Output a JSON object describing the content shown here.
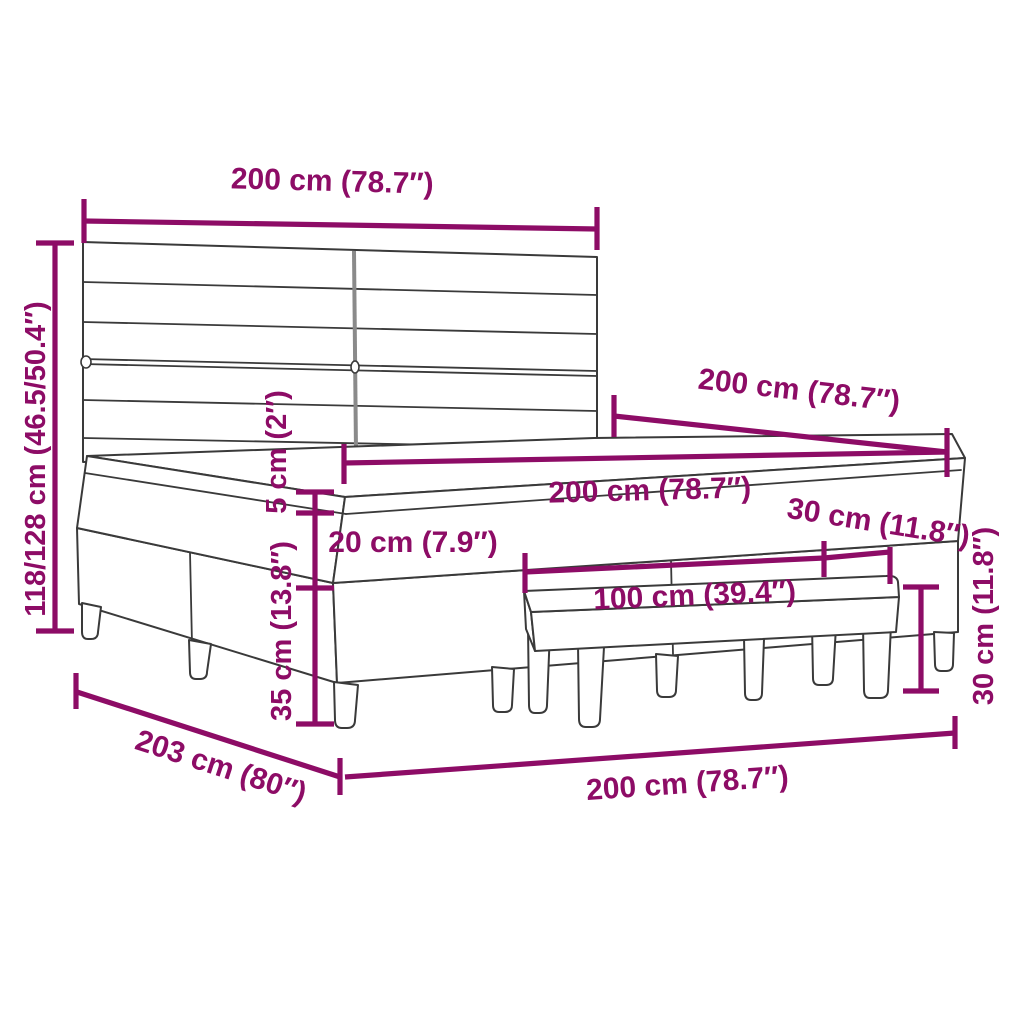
{
  "diagram": {
    "kind": "furniture-dimension-diagram",
    "subject": "box spring bed with striped headboard, mattress and bench",
    "colors": {
      "accent": "#8D0C66",
      "line_art": "#3a3a3a",
      "seam": "#8a8a8a",
      "background": "#ffffff"
    },
    "labels": {
      "headboard_width": "200 cm (78.7″)",
      "total_height": "118/128 cm (46.5/50.4″)",
      "bed_length_top": "200 cm (78.7″)",
      "topper_height": "5 cm (2″)",
      "mattress_width": "200 cm (78.7″)",
      "mattress_height": "20 cm (7.9″)",
      "bench_depth": "30 cm (11.8″)",
      "bench_width": "100 cm (39.4″)",
      "base_height": "35 cm (13.8″)",
      "bench_height": "30 cm (11.8″)",
      "bed_length_bottom": "203 cm (80″)",
      "bed_width_bottom": "200 cm (78.7″)"
    }
  }
}
